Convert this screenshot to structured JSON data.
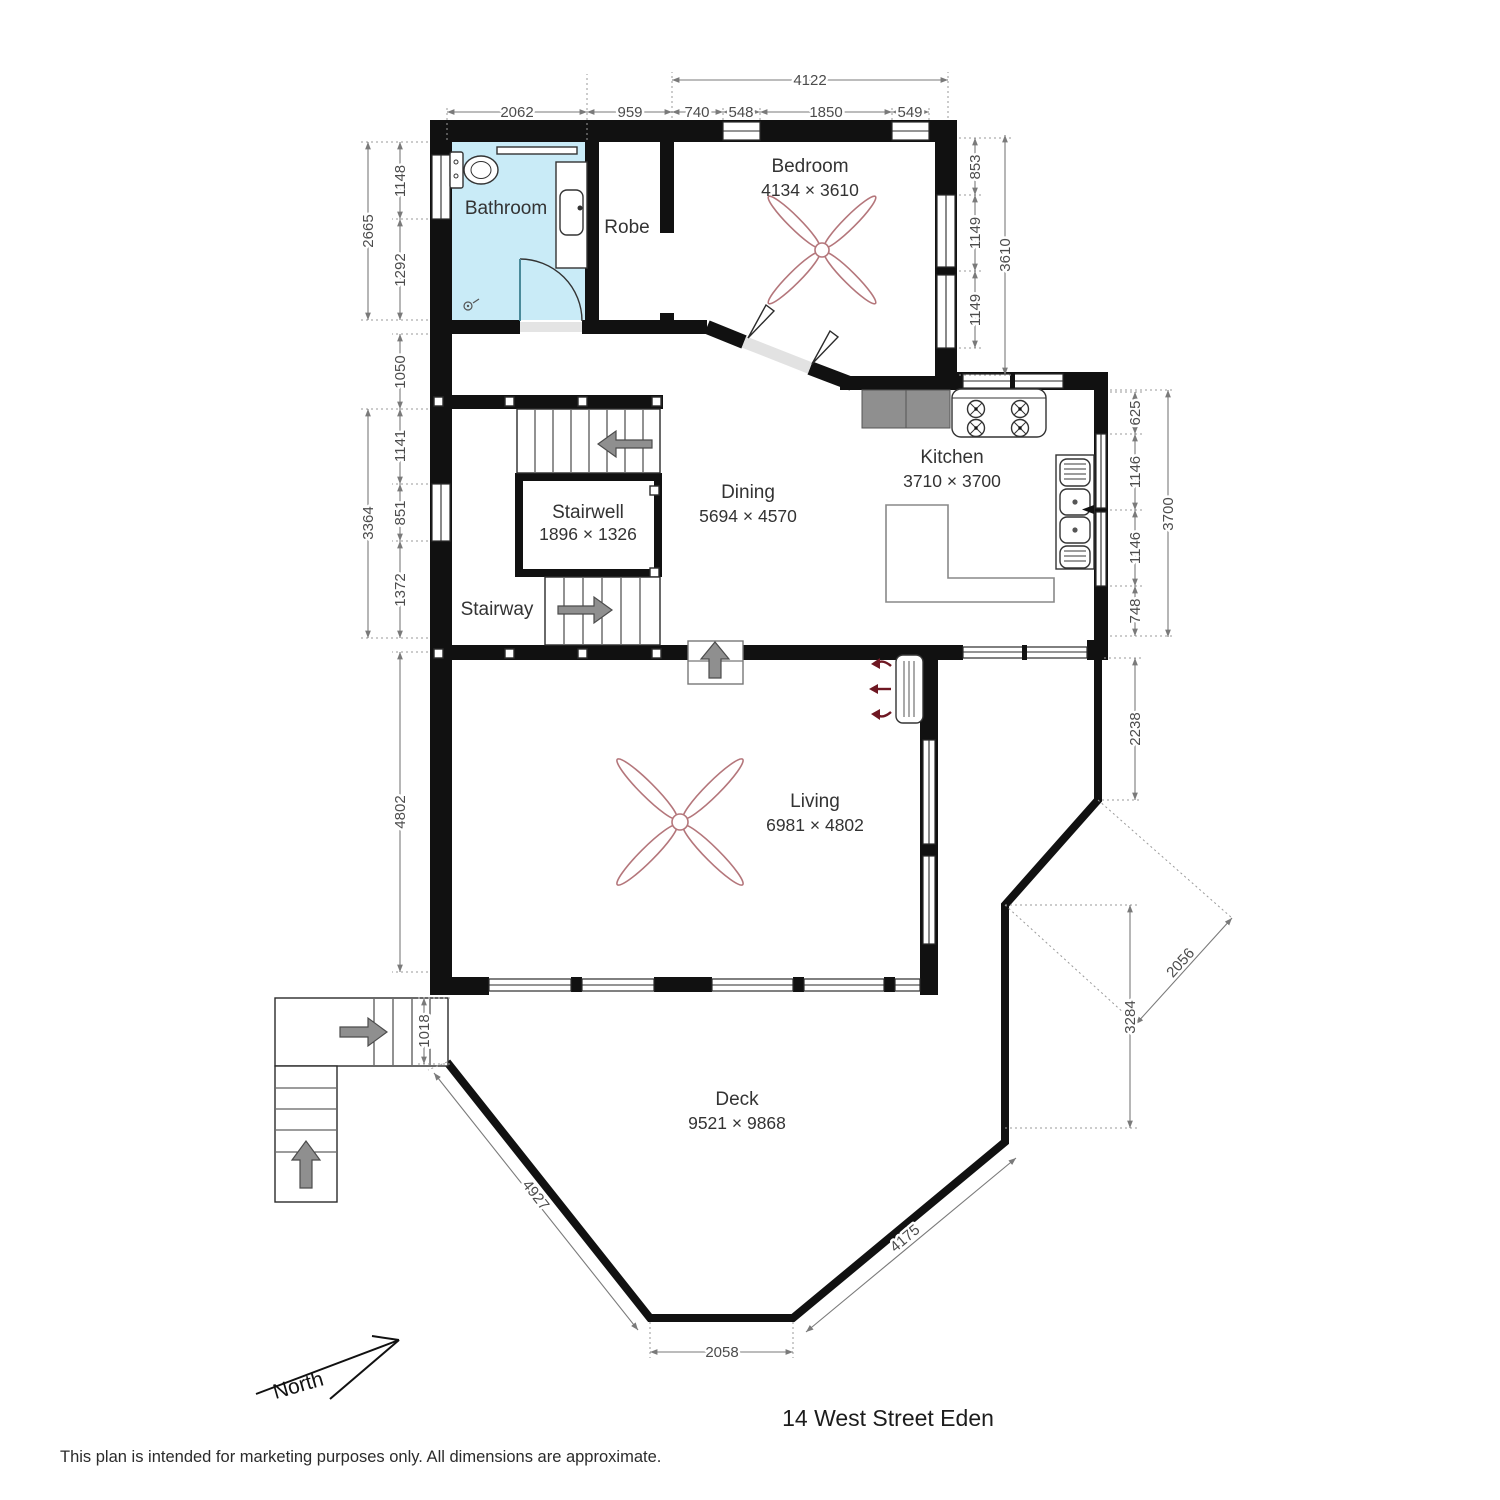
{
  "meta": {
    "address_title": "14 West Street Eden",
    "disclaimer": "This plan is intended for marketing purposes only. All dimensions are approximate.",
    "north_label": "North"
  },
  "rooms": {
    "bathroom": {
      "label": "Bathroom"
    },
    "robe": {
      "label": "Robe"
    },
    "bedroom": {
      "label": "Bedroom",
      "size": "4134 × 3610"
    },
    "kitchen": {
      "label": "Kitchen",
      "size": "3710 × 3700"
    },
    "dining": {
      "label": "Dining",
      "size": "5694 × 4570"
    },
    "stairwell": {
      "label": "Stairwell",
      "size": "1896 × 1326"
    },
    "stairway": {
      "label": "Stairway"
    },
    "living": {
      "label": "Living",
      "size": "6981 × 4802"
    },
    "deck": {
      "label": "Deck",
      "size": "9521 × 9868"
    }
  },
  "dimensions": {
    "top": {
      "overall": "4122",
      "bathroom_width": "2062",
      "robe_width": "959",
      "bedroom_seg1": "740",
      "bedroom_window1": "548",
      "bedroom_seg2": "1850",
      "bedroom_window2": "549"
    },
    "left": {
      "bathroom_overall": "2665",
      "bathroom_upper": "1148",
      "bathroom_lower": "1292",
      "hall": "1050",
      "stair_overall": "3364",
      "stair_upper": "1141",
      "stair_window": "851",
      "stair_lower": "1372",
      "living_height": "4802",
      "entry_stairs": "1018"
    },
    "right": {
      "bedroom_wall": "853",
      "bedroom_window1": "1149",
      "bedroom_window2": "1149",
      "bedroom_overall": "3610",
      "kitchen_wall": "625",
      "kitchen_window1": "1146",
      "kitchen_window2": "1146",
      "kitchen_lower": "748",
      "kitchen_overall": "3700",
      "deck_upper": "2238",
      "deck_diagonal": "2056",
      "deck_vertical": "3284"
    },
    "deck": {
      "southwest": "4927",
      "south": "2058",
      "southeast": "4175"
    }
  },
  "colors": {
    "bathroom_fill": "#c9ebf7",
    "wall": "#111111",
    "fan_stroke": "#b4767b",
    "stair_arrow_gray": "#8f8f8f",
    "heater_arrow_red": "#6e1722",
    "counter_gray": "#8f8f8f",
    "dim_text": "#4c4c4c"
  }
}
